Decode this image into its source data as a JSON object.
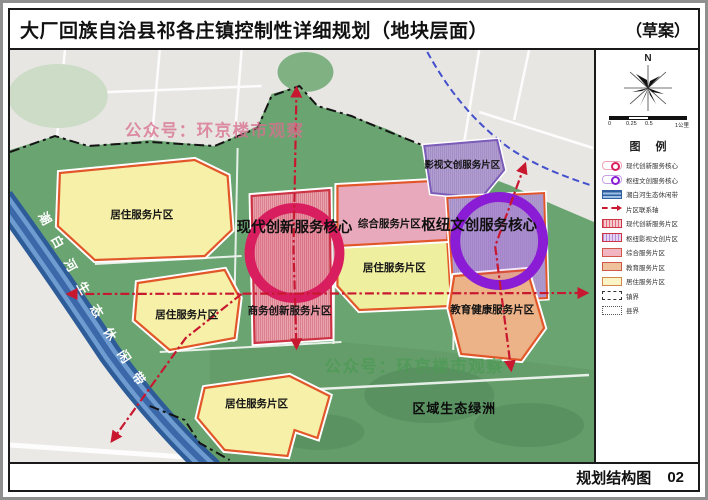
{
  "title": {
    "main": "大厂回族自治县祁各庄镇控制性详细规划（地块层面）",
    "draft": "（草案）"
  },
  "compass": {
    "n": "N"
  },
  "scalebar": {
    "t0": "0",
    "t1": "0.25",
    "t2": "0.5",
    "t3": "1公里"
  },
  "legend": {
    "heading": "图  例",
    "items": [
      {
        "label": "现代创新服务核心",
        "type": "core",
        "color": "#d81e5e"
      },
      {
        "label": "枢纽文创服务核心",
        "type": "core",
        "color": "#8a1cd6"
      },
      {
        "label": "潮白河生态休闲带",
        "type": "river-band",
        "color": "#2f5f9e"
      },
      {
        "label": "片区联系轴",
        "type": "axis",
        "color": "#c81830"
      },
      {
        "label": "现代创新服务片区",
        "type": "hatch",
        "fill": "#f6c9cf",
        "border": "#cc3344"
      },
      {
        "label": "枢纽影视文创片区",
        "type": "hatch",
        "fill": "#e4d4f2",
        "border": "#cc3344"
      },
      {
        "label": "综合服务片区",
        "type": "fill",
        "fill": "#f2b6c2",
        "border": "#d05848"
      },
      {
        "label": "教育服务片区",
        "type": "fill",
        "fill": "#f0c29c",
        "border": "#d05848"
      },
      {
        "label": "居住服务片区",
        "type": "fill",
        "fill": "#faf4c6",
        "border": "#d08848"
      },
      {
        "label": "镇界",
        "type": "boundary-town"
      },
      {
        "label": "县界",
        "type": "boundary-county"
      }
    ]
  },
  "map": {
    "labels": {
      "modern_core": "现代创新服务核心",
      "hub_core": "枢纽文创服务核心",
      "film": "影视文创服务片区",
      "comprehensive": "综合服务片区",
      "residential": "居住服务片区",
      "business": "商务创新服务片区",
      "education": "教育健康服务片区",
      "oasis": "区域生态绿洲",
      "river": "潮白河生态休闲带",
      "watermark": "公众号：环京楼市观察"
    },
    "colors": {
      "green_base": "#6aa471",
      "residential": "#f6f0a8",
      "comprehensive": "#e9a9bd",
      "education": "#ecb288",
      "modern_zone": "#eba3ad",
      "culture_zone": "#b9a6d4",
      "core_red": "#d81e5e",
      "core_purple": "#8a1cd6",
      "axis_red": "#c81830",
      "river_blue": "#2d5c99"
    }
  },
  "footer": {
    "label": "规划结构图",
    "number": "02"
  }
}
